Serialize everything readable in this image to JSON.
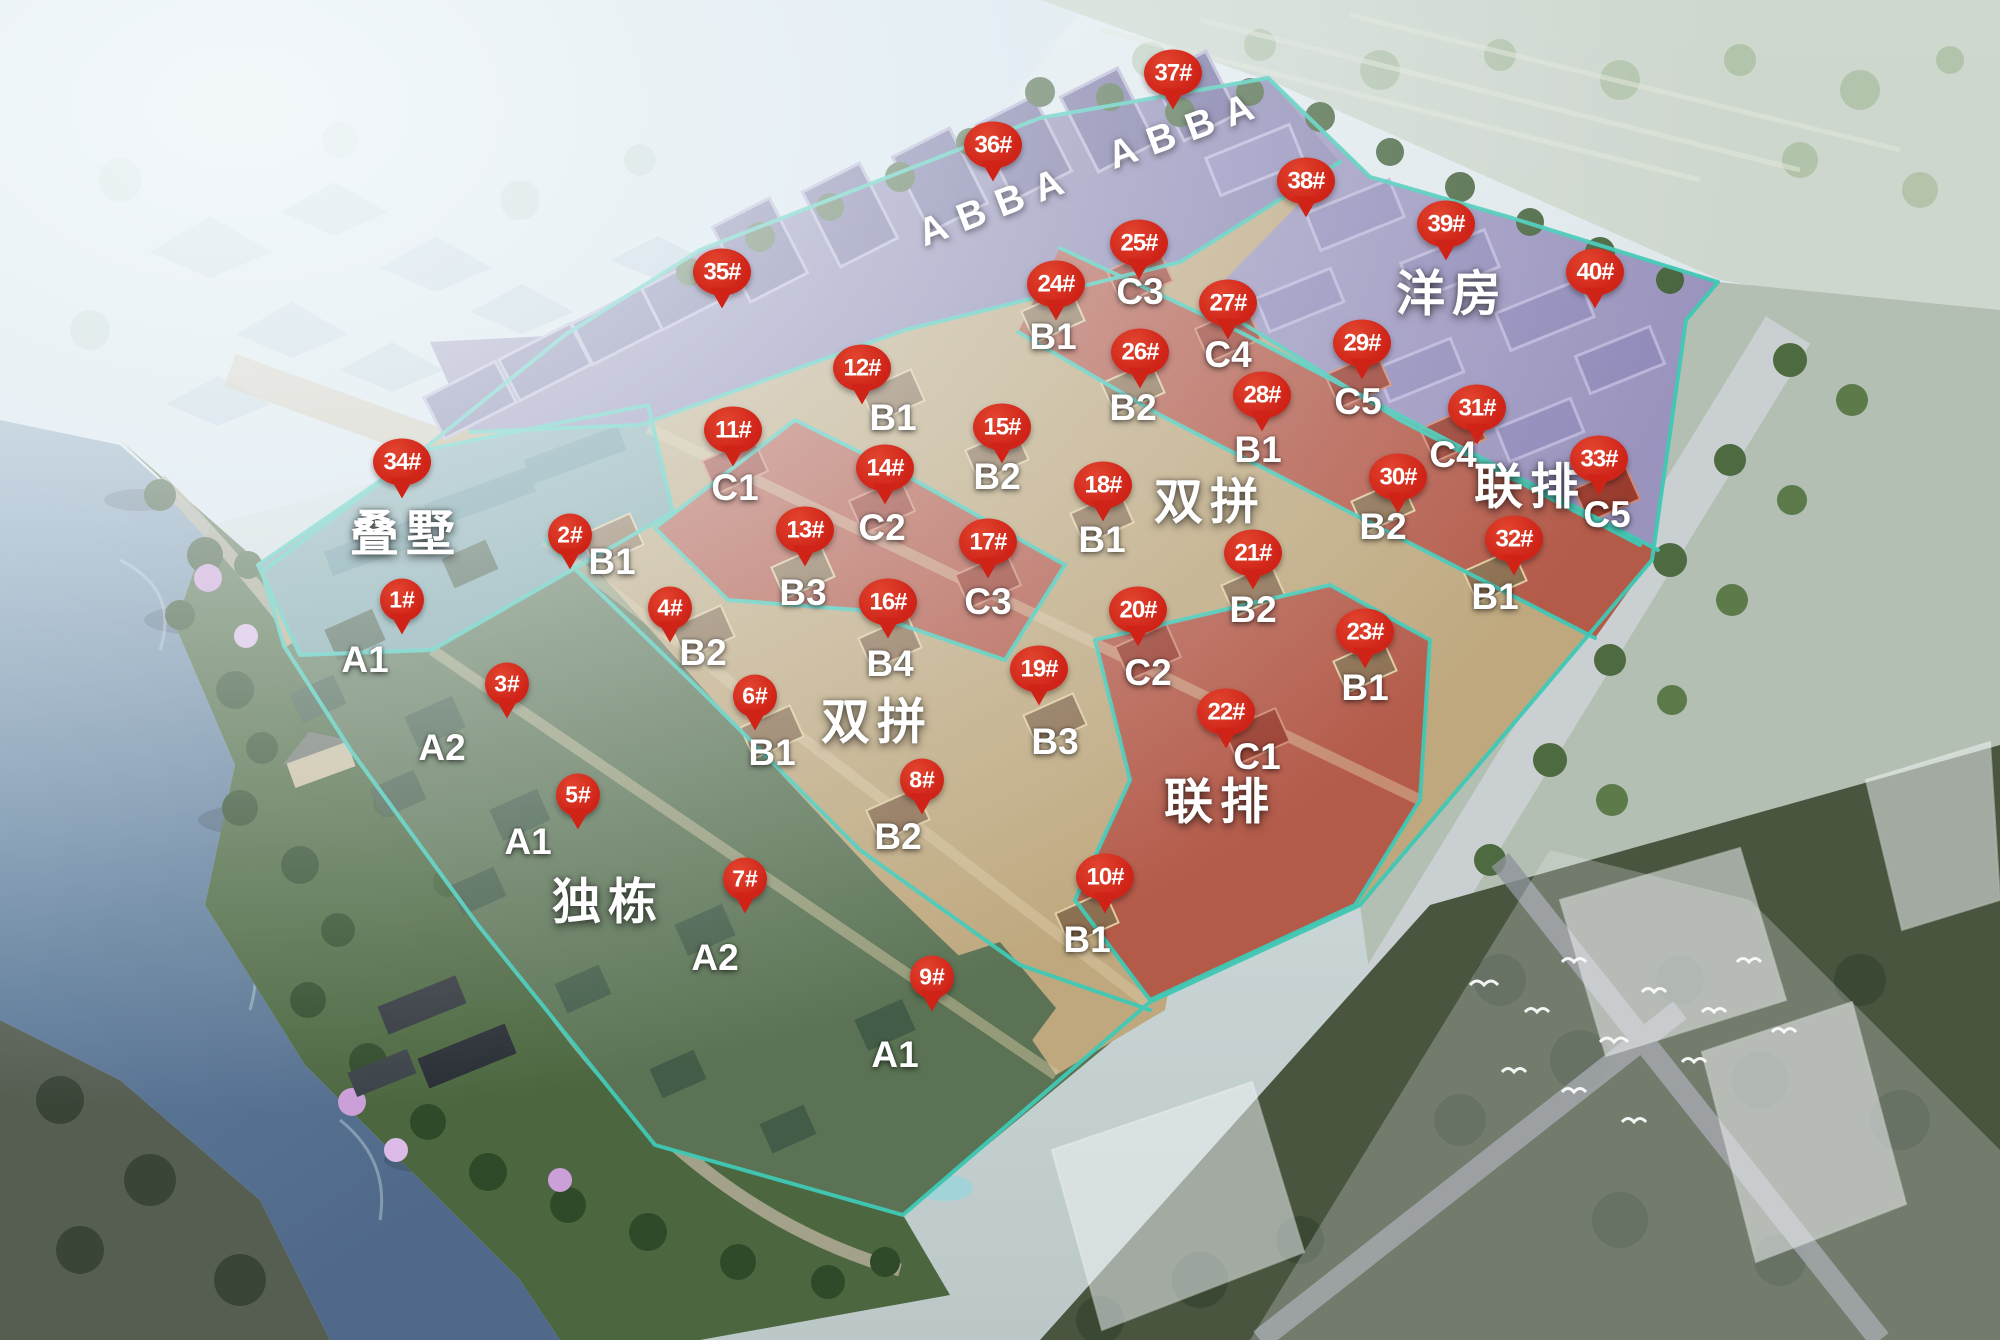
{
  "scene": {
    "width": 2000,
    "height": 1340,
    "kind": "residential-masterplan-render"
  },
  "colors": {
    "pin_red": "#cf2318",
    "boundary_teal": "#3fc9b6",
    "label_white": "#ffffff",
    "zone_green": "#5b7354",
    "zone_tan": "#bfa87e",
    "zone_red": "#b45a49",
    "zone_purple": "#8b85b2",
    "zone_stacked_teal": "#7ba4a8",
    "zone_flats_purple": "#9a93bd"
  },
  "zone_labels": [
    {
      "text": "叠墅",
      "x": 406,
      "y": 530
    },
    {
      "text": "独栋",
      "x": 608,
      "y": 898
    },
    {
      "text": "双拼",
      "x": 877,
      "y": 718
    },
    {
      "text": "双拼",
      "x": 1210,
      "y": 498
    },
    {
      "text": "联排",
      "x": 1220,
      "y": 798
    },
    {
      "text": "联排",
      "x": 1530,
      "y": 483
    },
    {
      "text": "洋房",
      "x": 1452,
      "y": 290
    }
  ],
  "tower_labels": [
    {
      "text": "ABBA",
      "x": 997,
      "y": 206,
      "rotation": -21
    },
    {
      "text": "ABBA",
      "x": 1187,
      "y": 130,
      "rotation": -20
    }
  ],
  "markers": [
    {
      "label": "1#",
      "x": 402,
      "y": 600
    },
    {
      "label": "2#",
      "x": 570,
      "y": 535
    },
    {
      "label": "3#",
      "x": 507,
      "y": 684
    },
    {
      "label": "4#",
      "x": 670,
      "y": 608
    },
    {
      "label": "5#",
      "x": 578,
      "y": 795
    },
    {
      "label": "6#",
      "x": 755,
      "y": 696
    },
    {
      "label": "7#",
      "x": 745,
      "y": 879
    },
    {
      "label": "8#",
      "x": 922,
      "y": 780
    },
    {
      "label": "9#",
      "x": 932,
      "y": 977
    },
    {
      "label": "10#",
      "x": 1105,
      "y": 877
    },
    {
      "label": "11#",
      "x": 733,
      "y": 430
    },
    {
      "label": "12#",
      "x": 862,
      "y": 368
    },
    {
      "label": "13#",
      "x": 805,
      "y": 530
    },
    {
      "label": "14#",
      "x": 885,
      "y": 468
    },
    {
      "label": "15#",
      "x": 1002,
      "y": 427
    },
    {
      "label": "16#",
      "x": 888,
      "y": 602
    },
    {
      "label": "17#",
      "x": 988,
      "y": 542
    },
    {
      "label": "18#",
      "x": 1103,
      "y": 485
    },
    {
      "label": "19#",
      "x": 1039,
      "y": 669
    },
    {
      "label": "20#",
      "x": 1138,
      "y": 610
    },
    {
      "label": "21#",
      "x": 1253,
      "y": 553
    },
    {
      "label": "22#",
      "x": 1226,
      "y": 712
    },
    {
      "label": "23#",
      "x": 1365,
      "y": 632
    },
    {
      "label": "24#",
      "x": 1056,
      "y": 284
    },
    {
      "label": "25#",
      "x": 1139,
      "y": 243
    },
    {
      "label": "26#",
      "x": 1140,
      "y": 352
    },
    {
      "label": "27#",
      "x": 1228,
      "y": 303
    },
    {
      "label": "28#",
      "x": 1262,
      "y": 395
    },
    {
      "label": "29#",
      "x": 1362,
      "y": 343
    },
    {
      "label": "30#",
      "x": 1398,
      "y": 477
    },
    {
      "label": "31#",
      "x": 1477,
      "y": 408
    },
    {
      "label": "32#",
      "x": 1514,
      "y": 539
    },
    {
      "label": "33#",
      "x": 1599,
      "y": 459
    },
    {
      "label": "34#",
      "x": 402,
      "y": 462
    },
    {
      "label": "35#",
      "x": 722,
      "y": 272
    },
    {
      "label": "36#",
      "x": 993,
      "y": 145
    },
    {
      "label": "37#",
      "x": 1173,
      "y": 73
    },
    {
      "label": "38#",
      "x": 1306,
      "y": 181
    },
    {
      "label": "39#",
      "x": 1446,
      "y": 224
    },
    {
      "label": "40#",
      "x": 1595,
      "y": 272
    }
  ],
  "unit_labels": [
    {
      "text": "A1",
      "x": 365,
      "y": 660
    },
    {
      "text": "A2",
      "x": 442,
      "y": 748
    },
    {
      "text": "A1",
      "x": 528,
      "y": 842
    },
    {
      "text": "A2",
      "x": 715,
      "y": 958
    },
    {
      "text": "A1",
      "x": 895,
      "y": 1055
    },
    {
      "text": "B1",
      "x": 612,
      "y": 562
    },
    {
      "text": "B2",
      "x": 703,
      "y": 653
    },
    {
      "text": "B1",
      "x": 772,
      "y": 753
    },
    {
      "text": "B2",
      "x": 898,
      "y": 837
    },
    {
      "text": "B1",
      "x": 1087,
      "y": 940
    },
    {
      "text": "C1",
      "x": 735,
      "y": 488
    },
    {
      "text": "B3",
      "x": 803,
      "y": 593
    },
    {
      "text": "B4",
      "x": 890,
      "y": 664
    },
    {
      "text": "C2",
      "x": 882,
      "y": 528
    },
    {
      "text": "C3",
      "x": 988,
      "y": 602
    },
    {
      "text": "B3",
      "x": 1055,
      "y": 742
    },
    {
      "text": "C2",
      "x": 1148,
      "y": 673
    },
    {
      "text": "C1",
      "x": 1257,
      "y": 757
    },
    {
      "text": "B1",
      "x": 893,
      "y": 418
    },
    {
      "text": "B2",
      "x": 997,
      "y": 477
    },
    {
      "text": "B1",
      "x": 1053,
      "y": 337
    },
    {
      "text": "C3",
      "x": 1140,
      "y": 292
    },
    {
      "text": "B2",
      "x": 1133,
      "y": 408
    },
    {
      "text": "C4",
      "x": 1228,
      "y": 355
    },
    {
      "text": "B1",
      "x": 1102,
      "y": 540
    },
    {
      "text": "B2",
      "x": 1253,
      "y": 610
    },
    {
      "text": "B1",
      "x": 1365,
      "y": 688
    },
    {
      "text": "C5",
      "x": 1358,
      "y": 402
    },
    {
      "text": "B1",
      "x": 1258,
      "y": 450
    },
    {
      "text": "B2",
      "x": 1383,
      "y": 527
    },
    {
      "text": "C4",
      "x": 1453,
      "y": 455
    },
    {
      "text": "C5",
      "x": 1607,
      "y": 515
    },
    {
      "text": "B1",
      "x": 1495,
      "y": 597
    }
  ]
}
